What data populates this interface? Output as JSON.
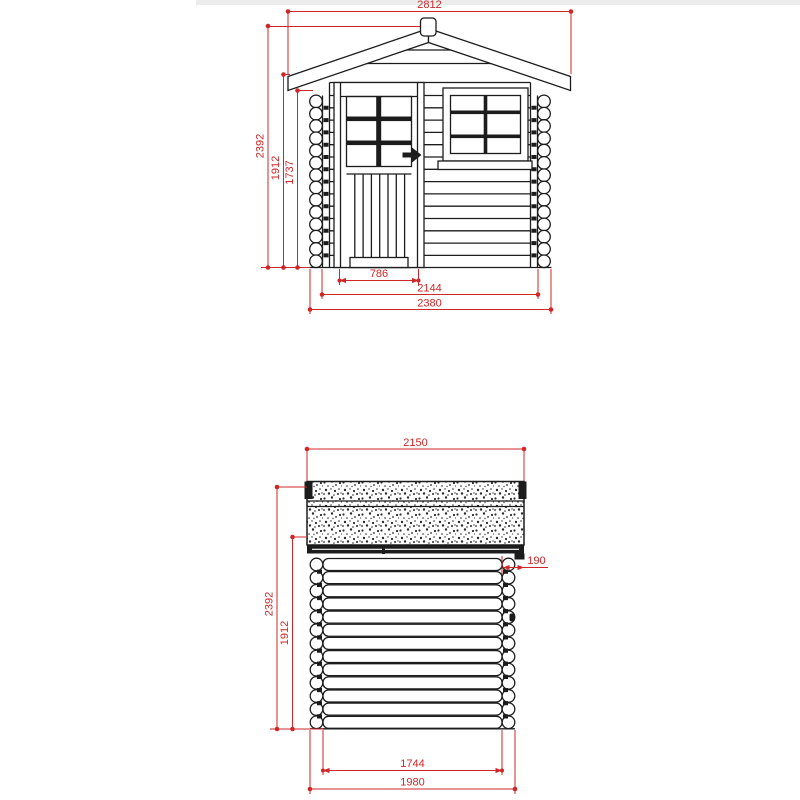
{
  "title": "Log cabin shed technical drawing",
  "colors": {
    "ink": "#1c1c1c",
    "dimension_red": "#cf2727",
    "background": "#ffffff",
    "top_strip": "#ececec"
  },
  "front_view": {
    "label": "front-elevation",
    "dims": {
      "roof_overall_width": "2812",
      "total_height": "2392",
      "eaves_height": "1912",
      "wall_top_height": "1737",
      "door_width": "786",
      "wall_outer_width": "2144",
      "log_end_width": "2380"
    }
  },
  "side_view": {
    "label": "side-elevation",
    "dims": {
      "roof_depth": "2150",
      "roof_overhang": "190",
      "total_height": "2392",
      "wall_height": "1912",
      "wall_outer_depth": "1744",
      "log_end_depth": "1980"
    }
  }
}
